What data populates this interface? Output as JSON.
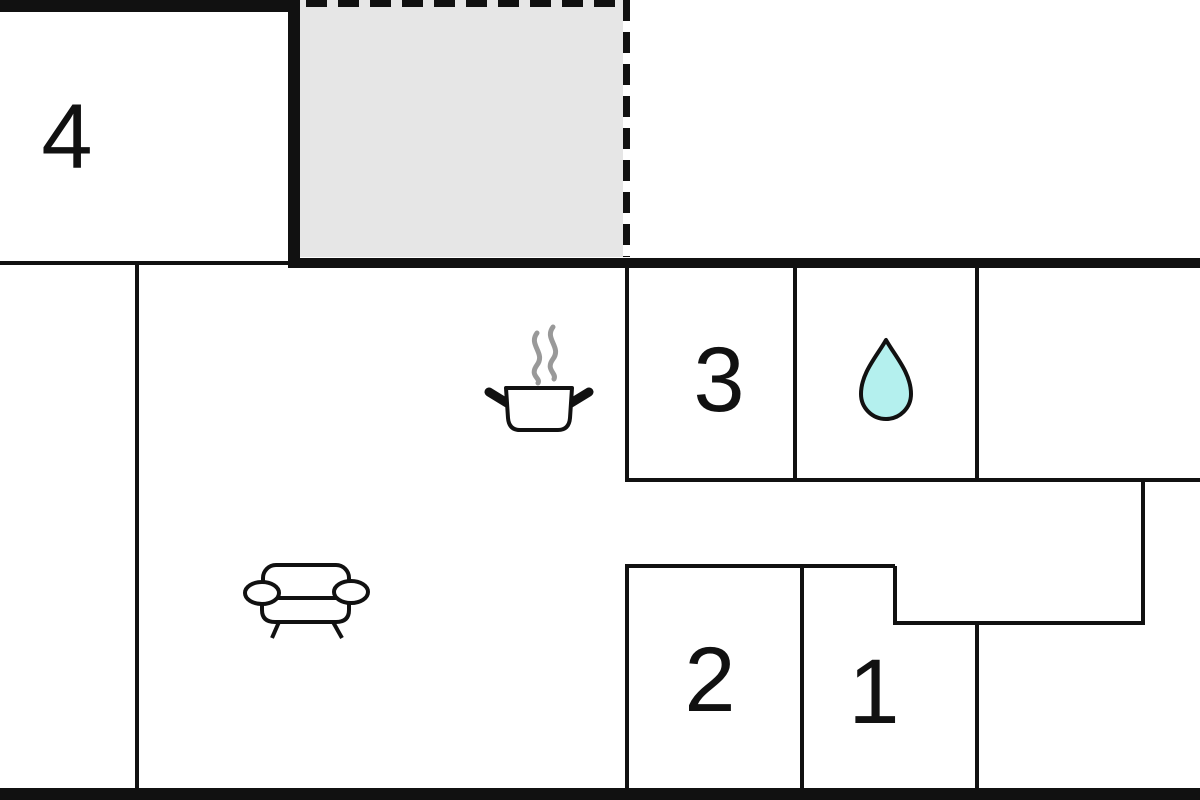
{
  "floor_plan": {
    "type": "apartment-floor-plan",
    "rooms": [
      {
        "id": "room-4",
        "label": "4"
      },
      {
        "id": "room-3",
        "label": "3"
      },
      {
        "id": "room-2",
        "label": "2"
      },
      {
        "id": "room-1",
        "label": "1"
      }
    ],
    "areas": {
      "terrace": "dashed-outline gray area (terrace/porch)",
      "kitchen": "marked with cooking-pot icon",
      "bathroom": "marked with water-drop icon",
      "living_room": "marked with sofa icon"
    },
    "icons": [
      "cooking-pot-icon",
      "steam-icon",
      "water-drop-icon",
      "sofa-icon"
    ],
    "colors": {
      "wall": "#111111",
      "terrace_fill": "#e6e6e6",
      "drop_fill": "#b4f0ee",
      "steam": "#999999",
      "background": "#ffffff",
      "label_text": "#111111"
    }
  }
}
